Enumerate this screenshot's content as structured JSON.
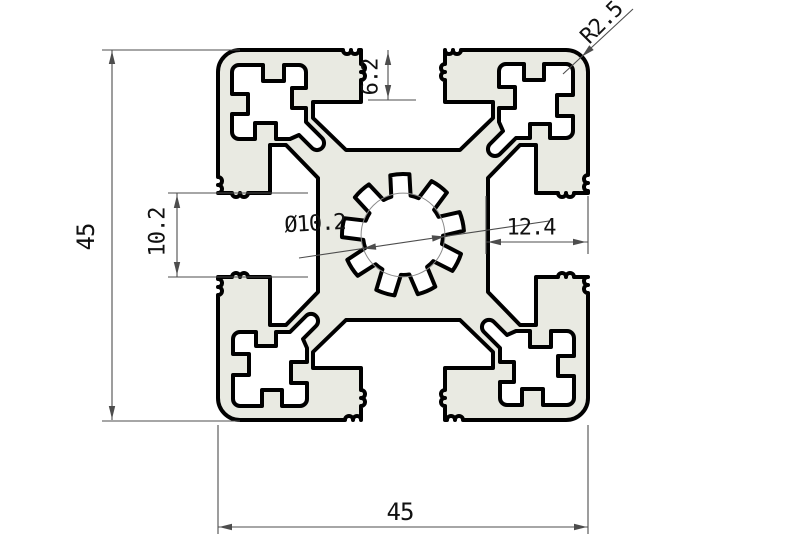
{
  "drawing": {
    "description": "Cross-section of a 45x45 T-slot aluminium extrusion profile with serrated center bore and four corner screw cavities",
    "dimensions": {
      "left_45": "45",
      "bottom_45": "45",
      "slot_depth": "6.2",
      "slot_opening": "10.2",
      "side_wall": "12.4",
      "center_bore": "Ø10.2",
      "corner_radius": "R2.5"
    },
    "colors": {
      "material_fill": "#e9eae2",
      "outline": "#000000",
      "dimension_line": "#4d4d4d",
      "dimension_text": "#111111",
      "reference_circle": "#8a8a8a"
    }
  }
}
